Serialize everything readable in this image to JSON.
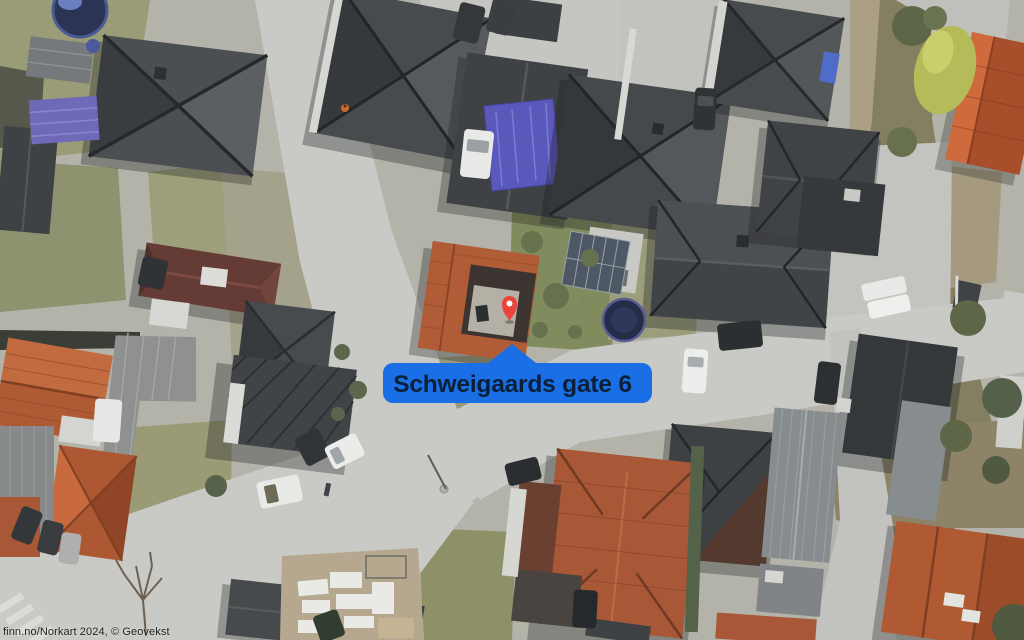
{
  "map": {
    "attribution": "finn.no/Norkart 2024, © Geovekst",
    "marker": {
      "label": "Schweigaards gate 6",
      "pin_color": "#e8443b",
      "pin_dot_color": "#ffffff",
      "label_bg_color": "#1a6fe6",
      "label_text_color": "#0a2038"
    },
    "palette": {
      "road": "#c9cac5",
      "ground": "#b4b3aa",
      "grass": "#9a9b77",
      "roof_dark": "#45494c",
      "roof_terracotta": "#b05a33",
      "tarp_blue": "#5a58ba",
      "vegetation": "#5d6647"
    }
  }
}
